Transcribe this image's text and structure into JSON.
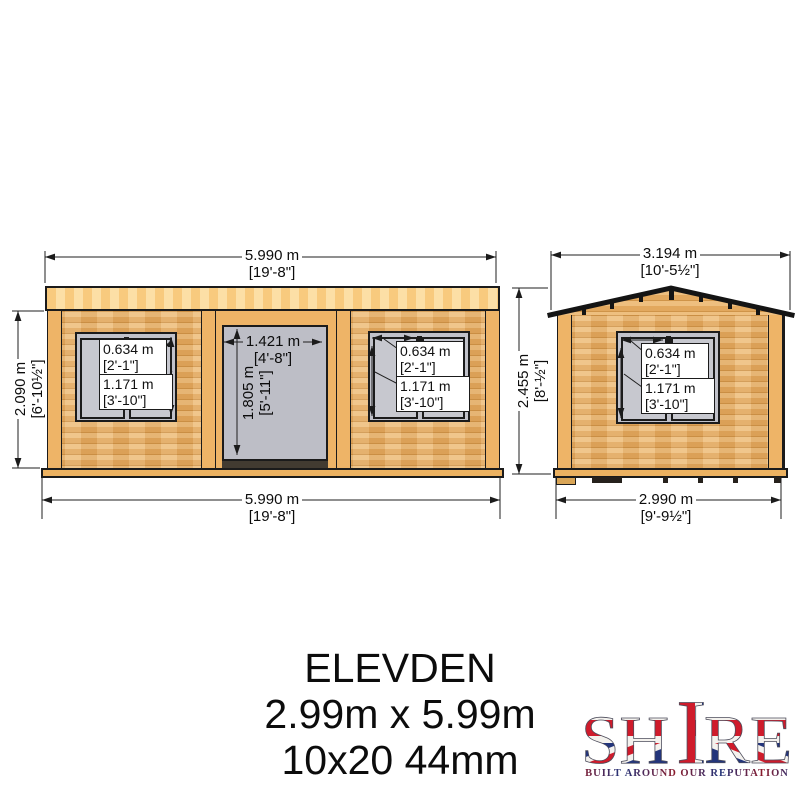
{
  "title_block": {
    "model": "ELEVDEN",
    "size_metric": "2.99m x 5.99m",
    "size_spec": "10x20 44mm"
  },
  "brand": {
    "name": "SHIRE",
    "name_sh": "SH",
    "name_i": "I",
    "name_re": "RE",
    "tagline": "BUILT AROUND OUR REPUTATION"
  },
  "front_elevation": {
    "overall_width": {
      "metric": "5.990 m",
      "imperial": "[19'-8\"]"
    },
    "overall_width_bottom": {
      "metric": "5.990 m",
      "imperial": "[19'-8\"]"
    },
    "eaves_height": {
      "metric": "2.090 m",
      "imperial": "[6'-10½\"]"
    },
    "door": {
      "width_metric": "1.421 m",
      "width_imperial": "[4'-8\"]",
      "height_metric": "1.805 m",
      "height_imperial": "[5'-11\"]"
    }
  },
  "side_elevation": {
    "overall_width": {
      "metric": "3.194 m",
      "imperial": "[10'-5½\"]"
    },
    "base_width": {
      "metric": "2.990 m",
      "imperial": "[9'-9½\"]"
    },
    "ridge_height": {
      "metric": "2.455 m",
      "imperial": "[8'-½\"]"
    }
  },
  "window_dims": {
    "pane_width_metric": "0.634 m",
    "pane_width_imperial": "[2'-1\"]",
    "height_metric": "1.171 m",
    "height_imperial": "[3'-10\"]"
  },
  "colors": {
    "wall": "#e2a85e",
    "fascia": "#f8ca7e",
    "glass": "#c1c2ca",
    "outline": "#1b1b1b",
    "brand_red": "#cf1b2b",
    "brand_blue": "#23357b"
  }
}
